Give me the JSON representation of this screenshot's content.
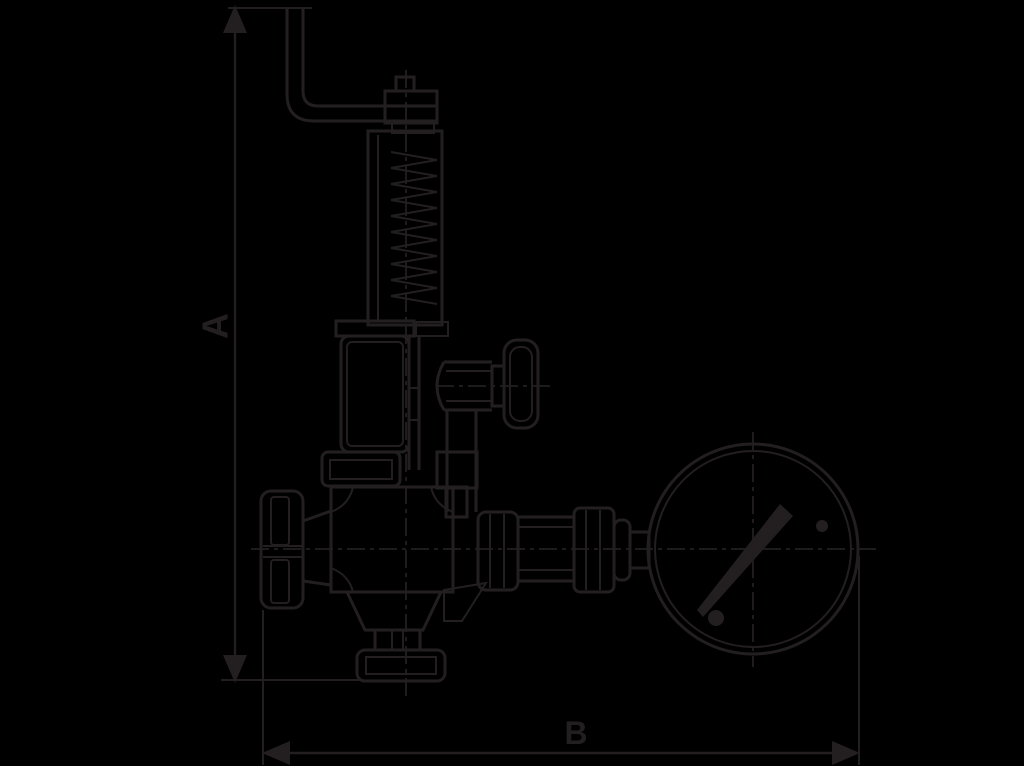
{
  "figure": {
    "description": "Dark technical line drawing on black background: spring-loaded overflow/safety valve with test lever, side knob, handwheel, bottom flange, piping to a round pressure gauge; overall height and width dimensioned with arrows."
  },
  "colors": {
    "background": "#000000",
    "line_art": "#231f20"
  },
  "dimension_labels": {
    "vertical": "A",
    "horizontal": "B"
  }
}
